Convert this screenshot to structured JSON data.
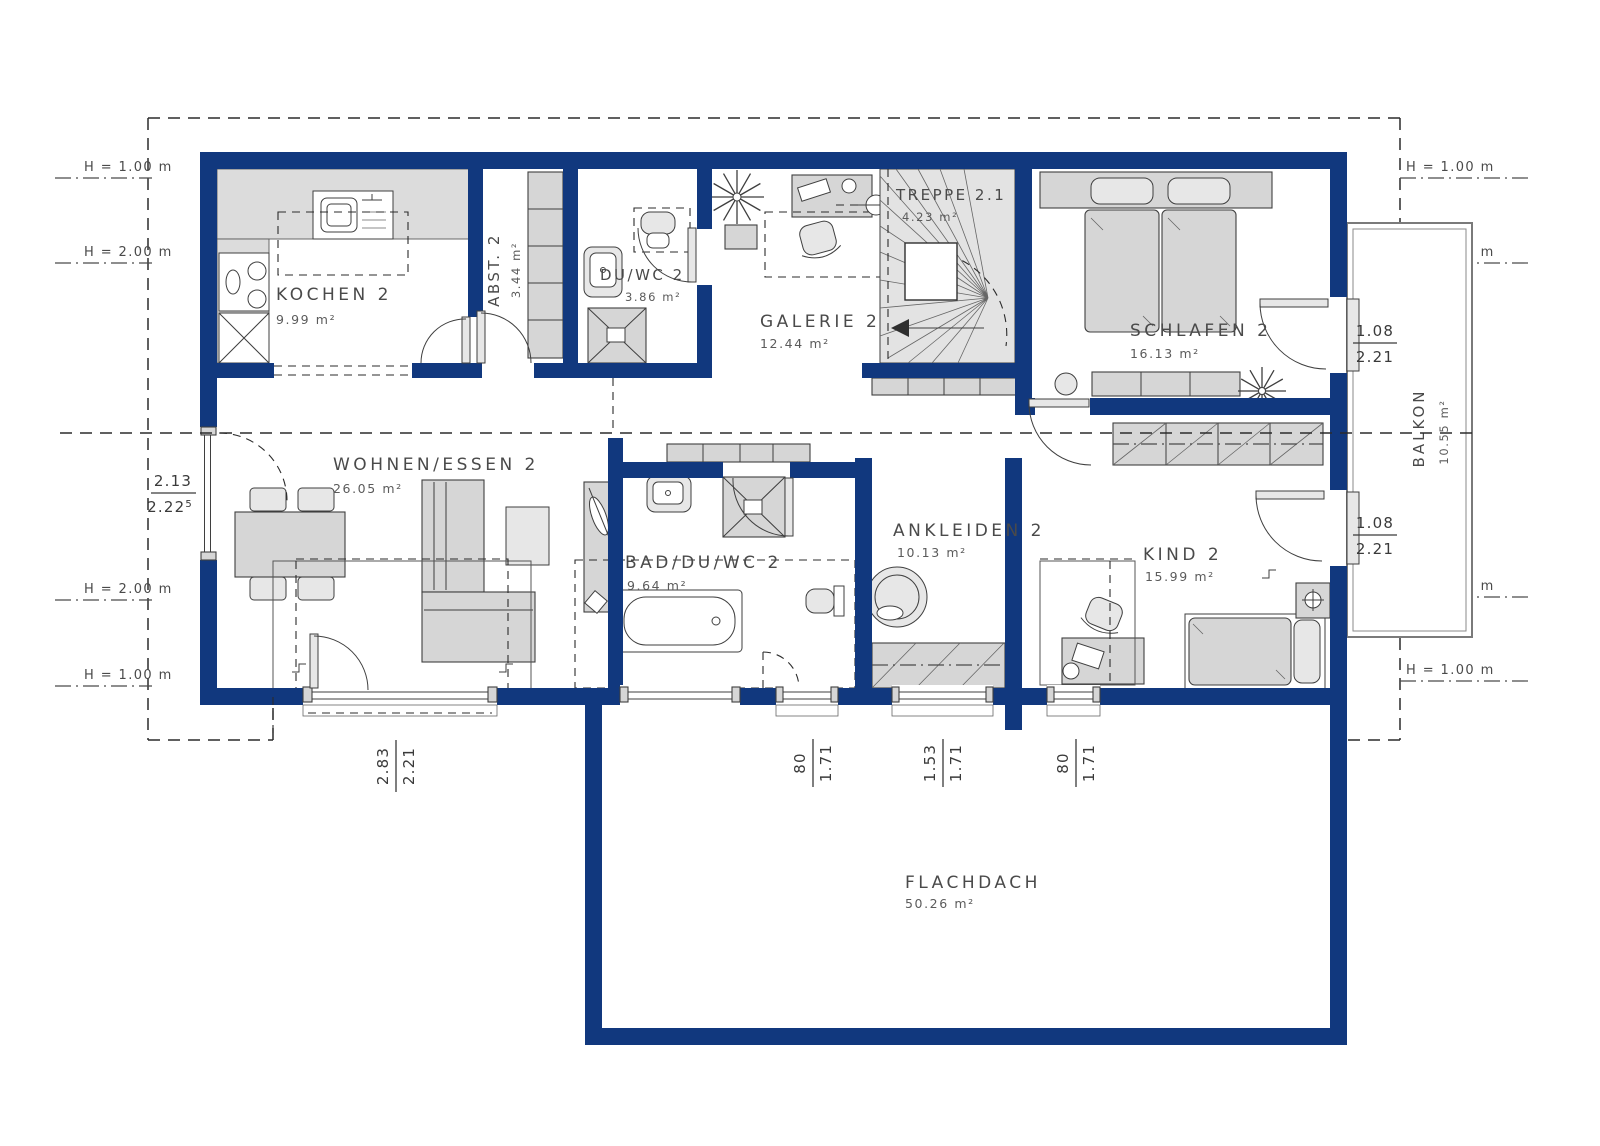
{
  "plan": {
    "rooms": {
      "kochen": {
        "name": "KOCHEN 2",
        "area": "9.99 m²"
      },
      "abst": {
        "name": "ABST. 2",
        "area": "3.44 m²"
      },
      "duwc": {
        "name": "DU/WC 2",
        "area": "3.86 m²"
      },
      "galerie": {
        "name": "GALERIE 2",
        "area": "12.44 m²"
      },
      "treppe": {
        "name": "TREPPE 2.1",
        "area": "4.23 m²"
      },
      "schlafen": {
        "name": "SCHLAFEN 2",
        "area": "16.13 m²"
      },
      "wohnen": {
        "name": "WOHNEN/ESSEN 2",
        "area": "26.05 m²"
      },
      "bad": {
        "name": "BAD/DU/WC 2",
        "area": "9.64 m²"
      },
      "ankleiden": {
        "name": "ANKLEIDEN 2",
        "area": "10.13 m²"
      },
      "kind": {
        "name": "KIND 2",
        "area": "15.99 m²"
      },
      "balkon": {
        "name": "BALKON",
        "area": "10.55 m²"
      },
      "flachdach": {
        "name": "FLACHDACH",
        "area": "50.26 m²"
      }
    },
    "dims": {
      "left_window": {
        "num": "2.13",
        "den": "2.22",
        "sup": "5"
      },
      "door_schlafen": {
        "num": "1.08",
        "den": "2.21"
      },
      "door_kind": {
        "num": "1.08",
        "den": "2.21"
      },
      "terrace_door": {
        "num": "2.83",
        "den": "2.21"
      },
      "win_bad": {
        "num": "80",
        "den": "1.71"
      },
      "win_ankleiden": {
        "num": "1.53",
        "den": "1.71"
      },
      "win_kind": {
        "num": "80",
        "den": "1.71"
      }
    },
    "height_marks": {
      "left": [
        "H = 1.00 m",
        "H = 2.00 m",
        "H = 2.00 m",
        "H = 1.00 m"
      ],
      "right": [
        "H = 1.00 m",
        "H = 2.00 m",
        "H = 2.00 m",
        "H = 1.00 m"
      ]
    }
  }
}
